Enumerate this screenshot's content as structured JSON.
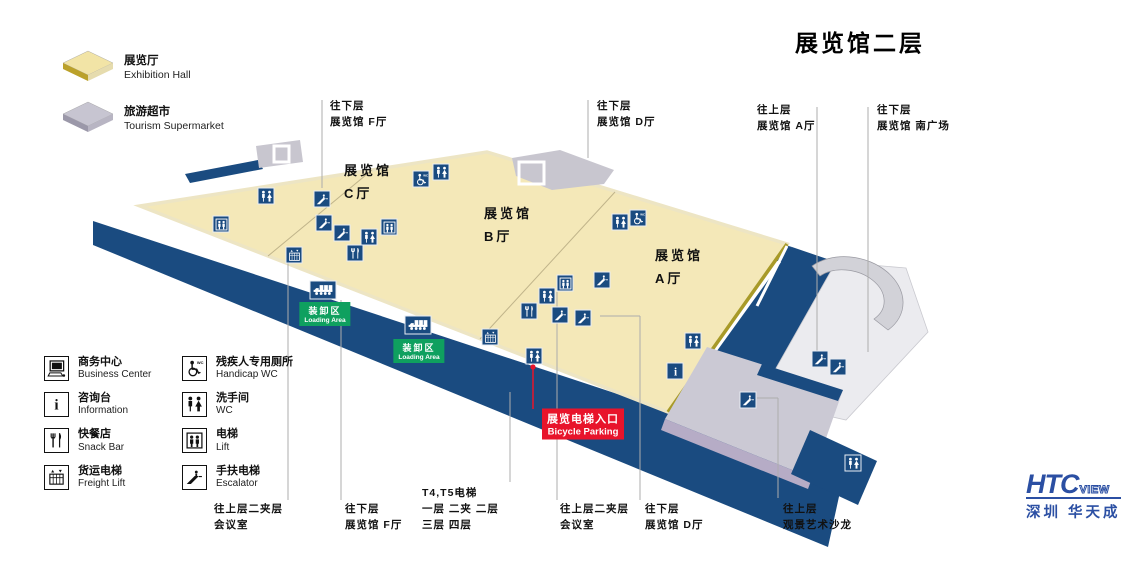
{
  "page_title": "展览馆二层",
  "colors": {
    "navy": "#1A4B80",
    "floor_yellow": "#F4E8B8",
    "floor_edge": "#EDE5C4",
    "gold_edge": "#A89A28",
    "gray": "#C9C7D2",
    "lavender": "#B6ACC6",
    "pale": "#EBEBEF",
    "green": "#0FA05F",
    "red": "#E8142B",
    "logo_blue": "#2B4FA3",
    "leader_line": "#ADADAD"
  },
  "legend_top": [
    {
      "zh": "展览厅",
      "en": "Exhibition Hall",
      "top": "#F2E4A6",
      "front": "#BBA12A",
      "side": "#E6DCAE"
    },
    {
      "zh": "旅游超市",
      "en": "Tourism Supermarket",
      "top": "#C7C5D1",
      "front": "#9B98A9",
      "side": "#B8B5C3"
    }
  ],
  "legend_facilities": [
    {
      "icon": "pc",
      "zh": "商务中心",
      "en": "Business Center"
    },
    {
      "icon": "info",
      "zh": "咨询台",
      "en": "Information"
    },
    {
      "icon": "sn",
      "zh": "快餐店",
      "en": "Snack Bar"
    },
    {
      "icon": "fr",
      "zh": "货运电梯",
      "en": "Freight Lift"
    },
    {
      "icon": "hc",
      "zh": "残疾人专用厕所",
      "en": "Handicap WC"
    },
    {
      "icon": "wc",
      "zh": "洗手间",
      "en": "WC"
    },
    {
      "icon": "lift",
      "zh": "电梯",
      "en": "Lift"
    },
    {
      "icon": "esc",
      "zh": "手扶电梯",
      "en": "Escalator"
    }
  ],
  "halls": [
    {
      "lines": [
        "展览馆",
        "C厅"
      ],
      "x": 344,
      "y": 160
    },
    {
      "lines": [
        "展览馆",
        "B厅"
      ],
      "x": 484,
      "y": 203
    },
    {
      "lines": [
        "展览馆",
        "A厅"
      ],
      "x": 655,
      "y": 245
    }
  ],
  "direction_labels": [
    {
      "lines": [
        "往下层",
        "展览馆 F厅"
      ],
      "x": 330,
      "y": 99
    },
    {
      "lines": [
        "往下层",
        "展览馆 D厅"
      ],
      "x": 597,
      "y": 99
    },
    {
      "lines": [
        "往上层",
        "展览馆 A厅"
      ],
      "x": 757,
      "y": 103
    },
    {
      "lines": [
        "往下层",
        "展览馆 南广场"
      ],
      "x": 877,
      "y": 103
    },
    {
      "lines": [
        "往上层二夹层",
        "会议室"
      ],
      "x": 214,
      "y": 502
    },
    {
      "lines": [
        "往下层",
        "展览馆 F厅"
      ],
      "x": 345,
      "y": 502
    },
    {
      "lines": [
        "T4,T5电梯",
        "一层  二夹  二层",
        "三层  四层"
      ],
      "x": 422,
      "y": 486
    },
    {
      "lines": [
        "往上层二夹层",
        "会议室"
      ],
      "x": 560,
      "y": 502
    },
    {
      "lines": [
        "往下层",
        "展览馆 D厅"
      ],
      "x": 645,
      "y": 502
    },
    {
      "lines": [
        "往上层",
        "观景艺术沙龙"
      ],
      "x": 783,
      "y": 502
    }
  ],
  "loading_labels": [
    {
      "zh": "装卸区",
      "en": "Loading Area",
      "x": 325,
      "y": 314,
      "truck_x": 323,
      "truck_y": 290
    },
    {
      "zh": "装卸区",
      "en": "Loading Area",
      "x": 419,
      "y": 351,
      "truck_x": 418,
      "truck_y": 325
    }
  ],
  "entrance_label": {
    "zh": "展览电梯入口",
    "en": "Bicycle Parking",
    "x": 583,
    "y": 424
  },
  "map_icons": [
    {
      "type": "wc",
      "x": 266,
      "y": 196
    },
    {
      "type": "wc",
      "x": 441,
      "y": 172
    },
    {
      "type": "wc",
      "x": 369,
      "y": 237
    },
    {
      "type": "wc",
      "x": 547,
      "y": 296
    },
    {
      "type": "wc",
      "x": 620,
      "y": 222
    },
    {
      "type": "wc",
      "x": 693,
      "y": 341
    },
    {
      "type": "wc",
      "x": 534,
      "y": 356
    },
    {
      "type": "wc",
      "x": 853,
      "y": 463
    },
    {
      "type": "lift",
      "x": 221,
      "y": 224
    },
    {
      "type": "lift",
      "x": 389,
      "y": 227
    },
    {
      "type": "lift",
      "x": 565,
      "y": 283
    },
    {
      "type": "esc",
      "x": 322,
      "y": 199
    },
    {
      "type": "esc",
      "x": 324,
      "y": 223
    },
    {
      "type": "esc",
      "x": 342,
      "y": 233
    },
    {
      "type": "esc",
      "x": 602,
      "y": 280
    },
    {
      "type": "esc",
      "x": 560,
      "y": 315
    },
    {
      "type": "esc",
      "x": 583,
      "y": 318
    },
    {
      "type": "esc",
      "x": 820,
      "y": 359
    },
    {
      "type": "esc",
      "x": 838,
      "y": 367
    },
    {
      "type": "esc",
      "x": 748,
      "y": 400
    },
    {
      "type": "hc",
      "x": 421,
      "y": 179
    },
    {
      "type": "hc",
      "x": 638,
      "y": 218
    },
    {
      "type": "sn",
      "x": 355,
      "y": 253
    },
    {
      "type": "sn",
      "x": 529,
      "y": 311
    },
    {
      "type": "fr",
      "x": 294,
      "y": 255
    },
    {
      "type": "fr",
      "x": 490,
      "y": 337
    },
    {
      "type": "info",
      "x": 675,
      "y": 371
    }
  ],
  "logo": {
    "brand": "HTC",
    "suffix": "VIEW",
    "sub": "深圳 华天成"
  }
}
